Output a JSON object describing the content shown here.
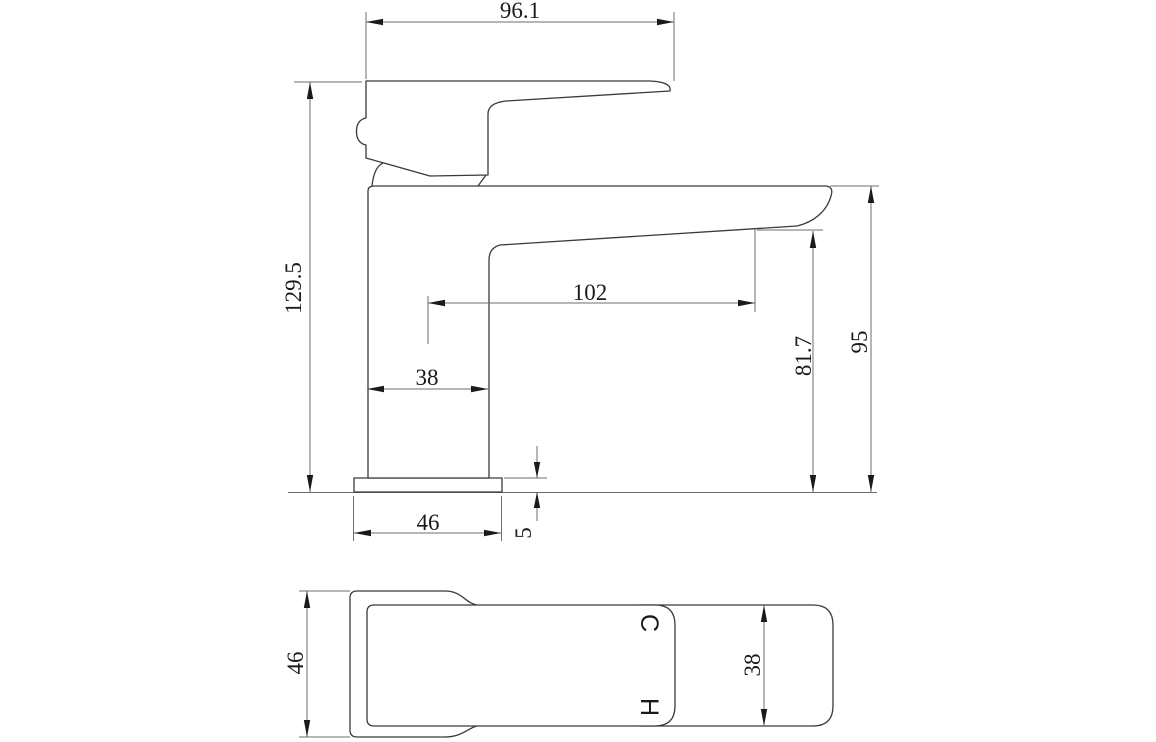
{
  "colors": {
    "outline": "#3a3a3a",
    "dim": "#6e6e6e",
    "ink": "#1a1a1a",
    "bg": "#ffffff"
  },
  "side_view": {
    "dim_handle_length": "96.1",
    "dim_overall_height": "129.5",
    "dim_spout_reach": "102",
    "dim_body_width": "38",
    "dim_base_width": "46",
    "dim_base_thickness": "5",
    "dim_outlet_height": "81.7",
    "dim_spout_top_height": "95"
  },
  "top_view": {
    "dim_base_depth": "46",
    "dim_spout_width": "38",
    "label_cold": "C",
    "label_hot": "H"
  }
}
